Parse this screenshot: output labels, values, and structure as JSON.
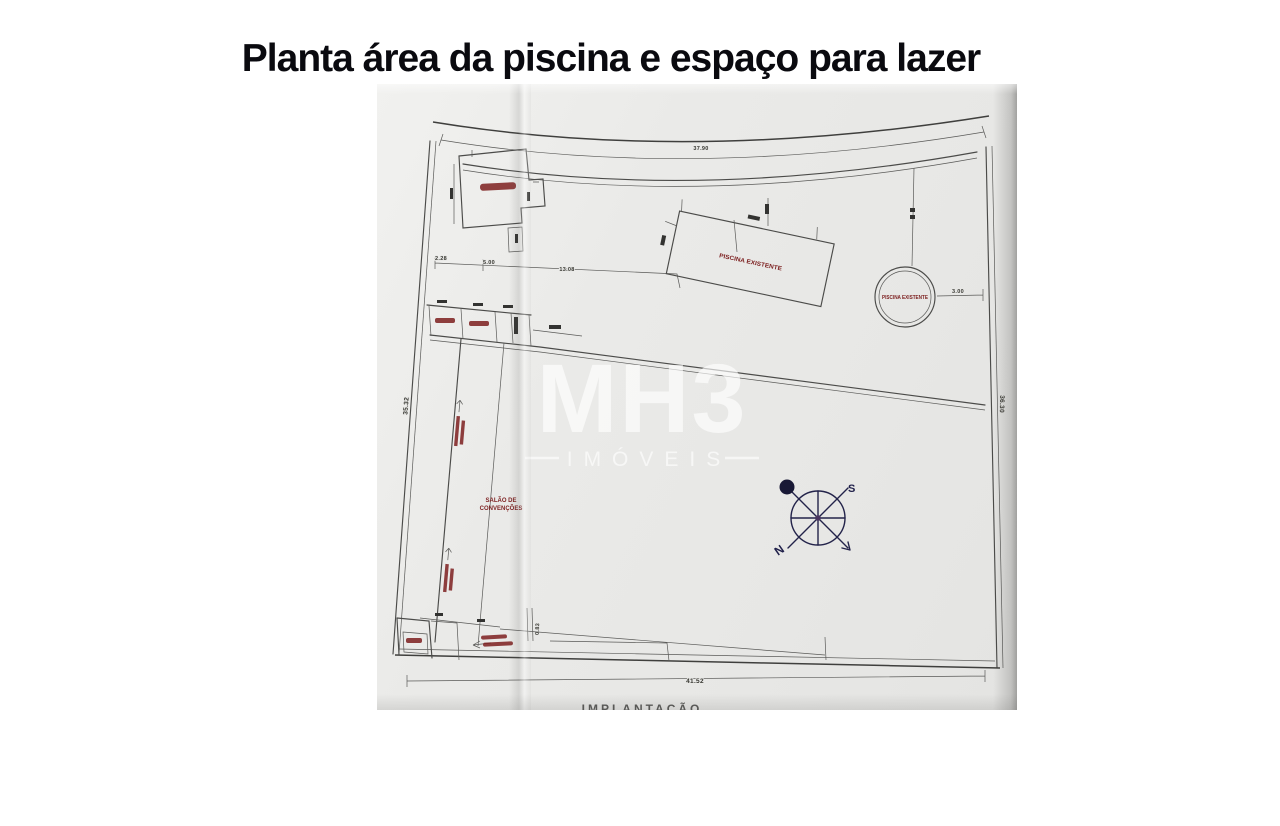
{
  "page": {
    "title": "Planta área da piscina e espaço para lazer"
  },
  "watermark": {
    "brand": "MH3",
    "subtitle": "IMÓVEIS"
  },
  "plan": {
    "caption": "IMPLANTAÇÃO",
    "labels": {
      "pool_rect": "PISCINA EXISTENTE",
      "pool_round": "PISCINA EXISTENTE",
      "hall_line1": "SALÃO DE",
      "hall_line2": "CONVENÇÕES"
    },
    "dims": {
      "top": "37.90",
      "left": "35.32",
      "right": "36.30",
      "bottom": "41.52",
      "d1": "2.28",
      "d2": "5.00",
      "d3": "13.08",
      "round_offset": "3.00",
      "ramp": "0.83"
    },
    "compass": {
      "n": "N",
      "s": "S"
    }
  }
}
